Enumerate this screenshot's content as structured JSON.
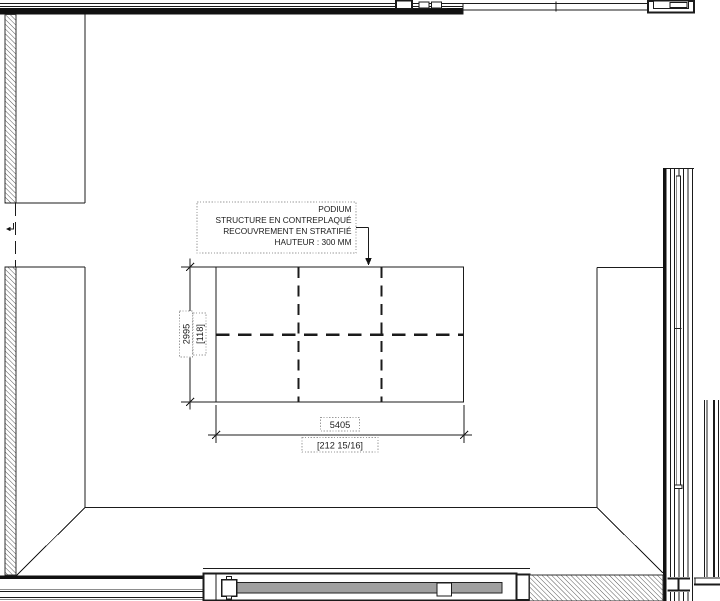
{
  "drawing_type": "architectural-floor-plan",
  "callout": {
    "lines": [
      "PODIUM",
      "STRUCTURE EN CONTREPLAQUÉ",
      "RECOUVREMENT EN STRATIFIÉ",
      "HAUTEUR : 300 MM"
    ]
  },
  "dimensions": {
    "podium_height": {
      "metric": "2995",
      "imperial": "[118]"
    },
    "podium_width": {
      "metric": "5405",
      "imperial": "[212 15/16]"
    }
  },
  "colors": {
    "line": "#1b1b1b",
    "wall_fill": "#111111",
    "dotted_box_border": "#9a9a9a",
    "door_leaf_fill": "#a0a0a0",
    "background": "#ffffff"
  }
}
